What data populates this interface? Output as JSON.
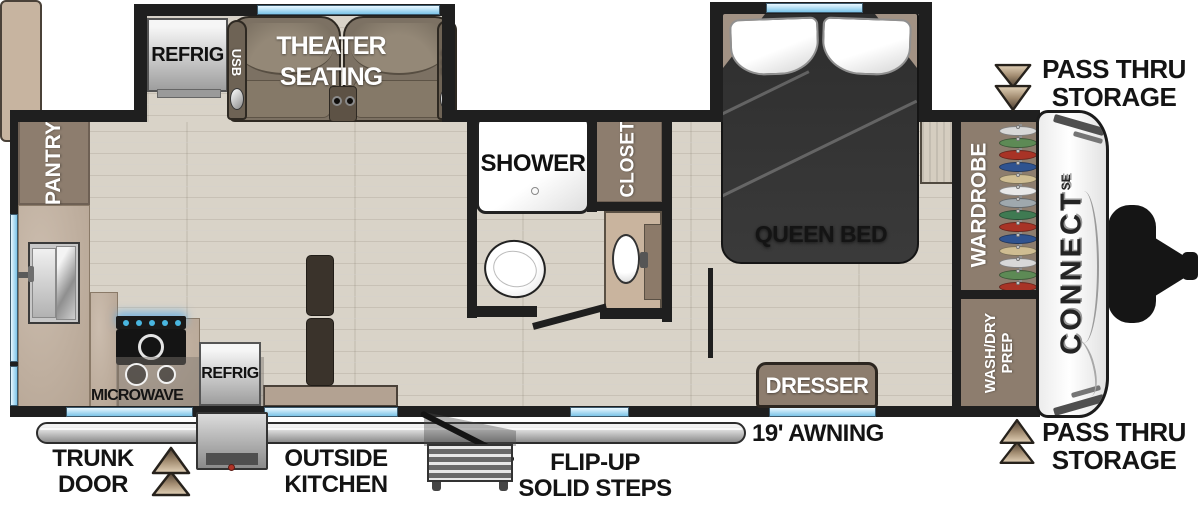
{
  "slideout": {
    "refrig": "REFRIG",
    "theater_line1": "THEATER",
    "theater_line2": "SEATING",
    "usb": "USB"
  },
  "kitchen": {
    "pantry": "PANTRY",
    "microwave": "MICROWAVE",
    "outside_refrig": "REFRIG"
  },
  "bathroom": {
    "shower": "SHOWER",
    "closet": "CLOSET"
  },
  "bedroom": {
    "queen_bed": "QUEEN BED",
    "wardrobe": "WARDROBE",
    "washdry_line1": "WASH/DRY",
    "washdry_line2": "PREP",
    "dresser": "DRESSER",
    "clothes_colors": [
      "#d8d8d8",
      "#5d8a55",
      "#a83326",
      "#2f5390",
      "#cfbd92",
      "#e9e9e9",
      "#9fa8ad",
      "#3f7a52",
      "#a83326",
      "#2f5390",
      "#cfbd92",
      "#d8d8d8",
      "#5d8a55",
      "#a83326"
    ]
  },
  "exterior": {
    "pass_thru_line1": "PASS THRU",
    "pass_thru_line2": "STORAGE",
    "awning": "19' AWNING",
    "trunk_line1": "TRUNK",
    "trunk_line2": "DOOR",
    "outside_kitchen_line1": "OUTSIDE",
    "outside_kitchen_line2": "KITCHEN",
    "steps_line1": "FLIP-UP",
    "steps_line2": "SOLID STEPS"
  },
  "brand": {
    "name": "CONNECT",
    "series": "SE"
  },
  "colors": {
    "wall": "#1f1f1f",
    "floor": "#d9d3c8",
    "cabinet": "#8d7d6e",
    "counter": "#c0ae9c",
    "seat": "#7c7163",
    "bed": "#3a3a3a",
    "window": "#7cc4e8",
    "arrow": "#c9b294"
  }
}
